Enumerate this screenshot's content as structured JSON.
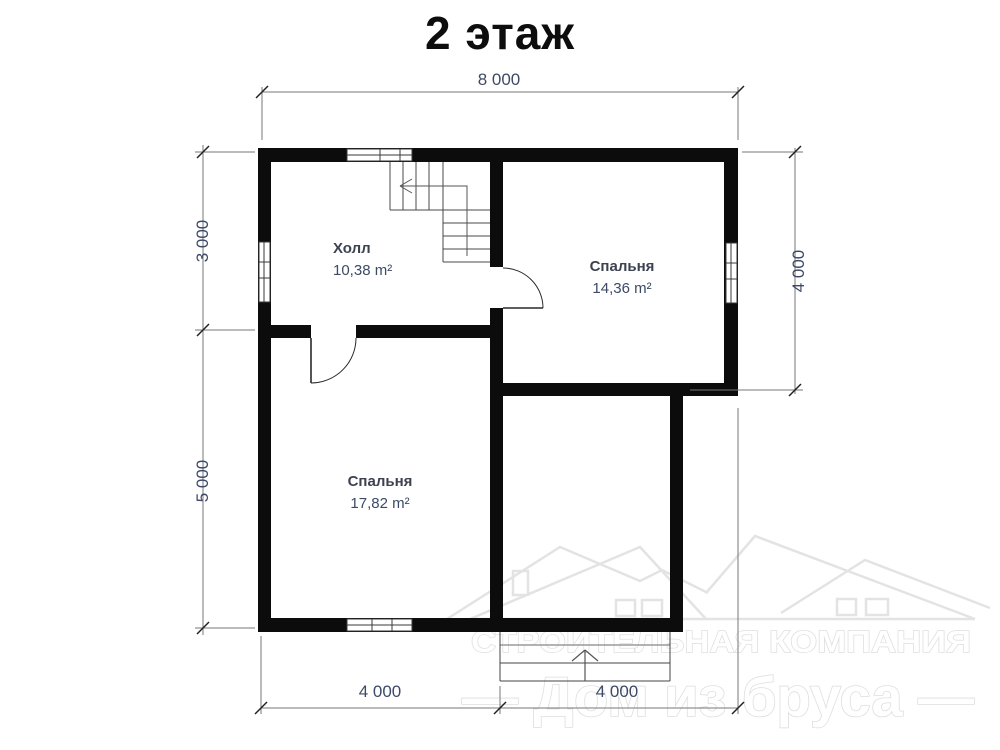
{
  "title": "2 этаж",
  "dimensions": {
    "top": "8 000",
    "left_upper": "3 000",
    "left_lower": "5 000",
    "right": "4 000",
    "bottom_left": "4 000",
    "bottom_right": "4 000"
  },
  "rooms": {
    "hall": {
      "name": "Холл",
      "area": "10,38 m²"
    },
    "bedroom_right": {
      "name": "Спальня",
      "area": "14,36 m²"
    },
    "bedroom_left": {
      "name": "Спальня",
      "area": "17,82 m²"
    }
  },
  "watermark": {
    "line1": "СТРОИТЕЛЬНАЯ КОМПАНИЯ",
    "line2": "— Дом из бруса —"
  },
  "colors": {
    "wall": "#0c0c0c",
    "dimension_text": "#3c4a66",
    "room_name_text": "#3c4250",
    "drawing_line": "#555555",
    "watermark": "#e3e3e3"
  }
}
